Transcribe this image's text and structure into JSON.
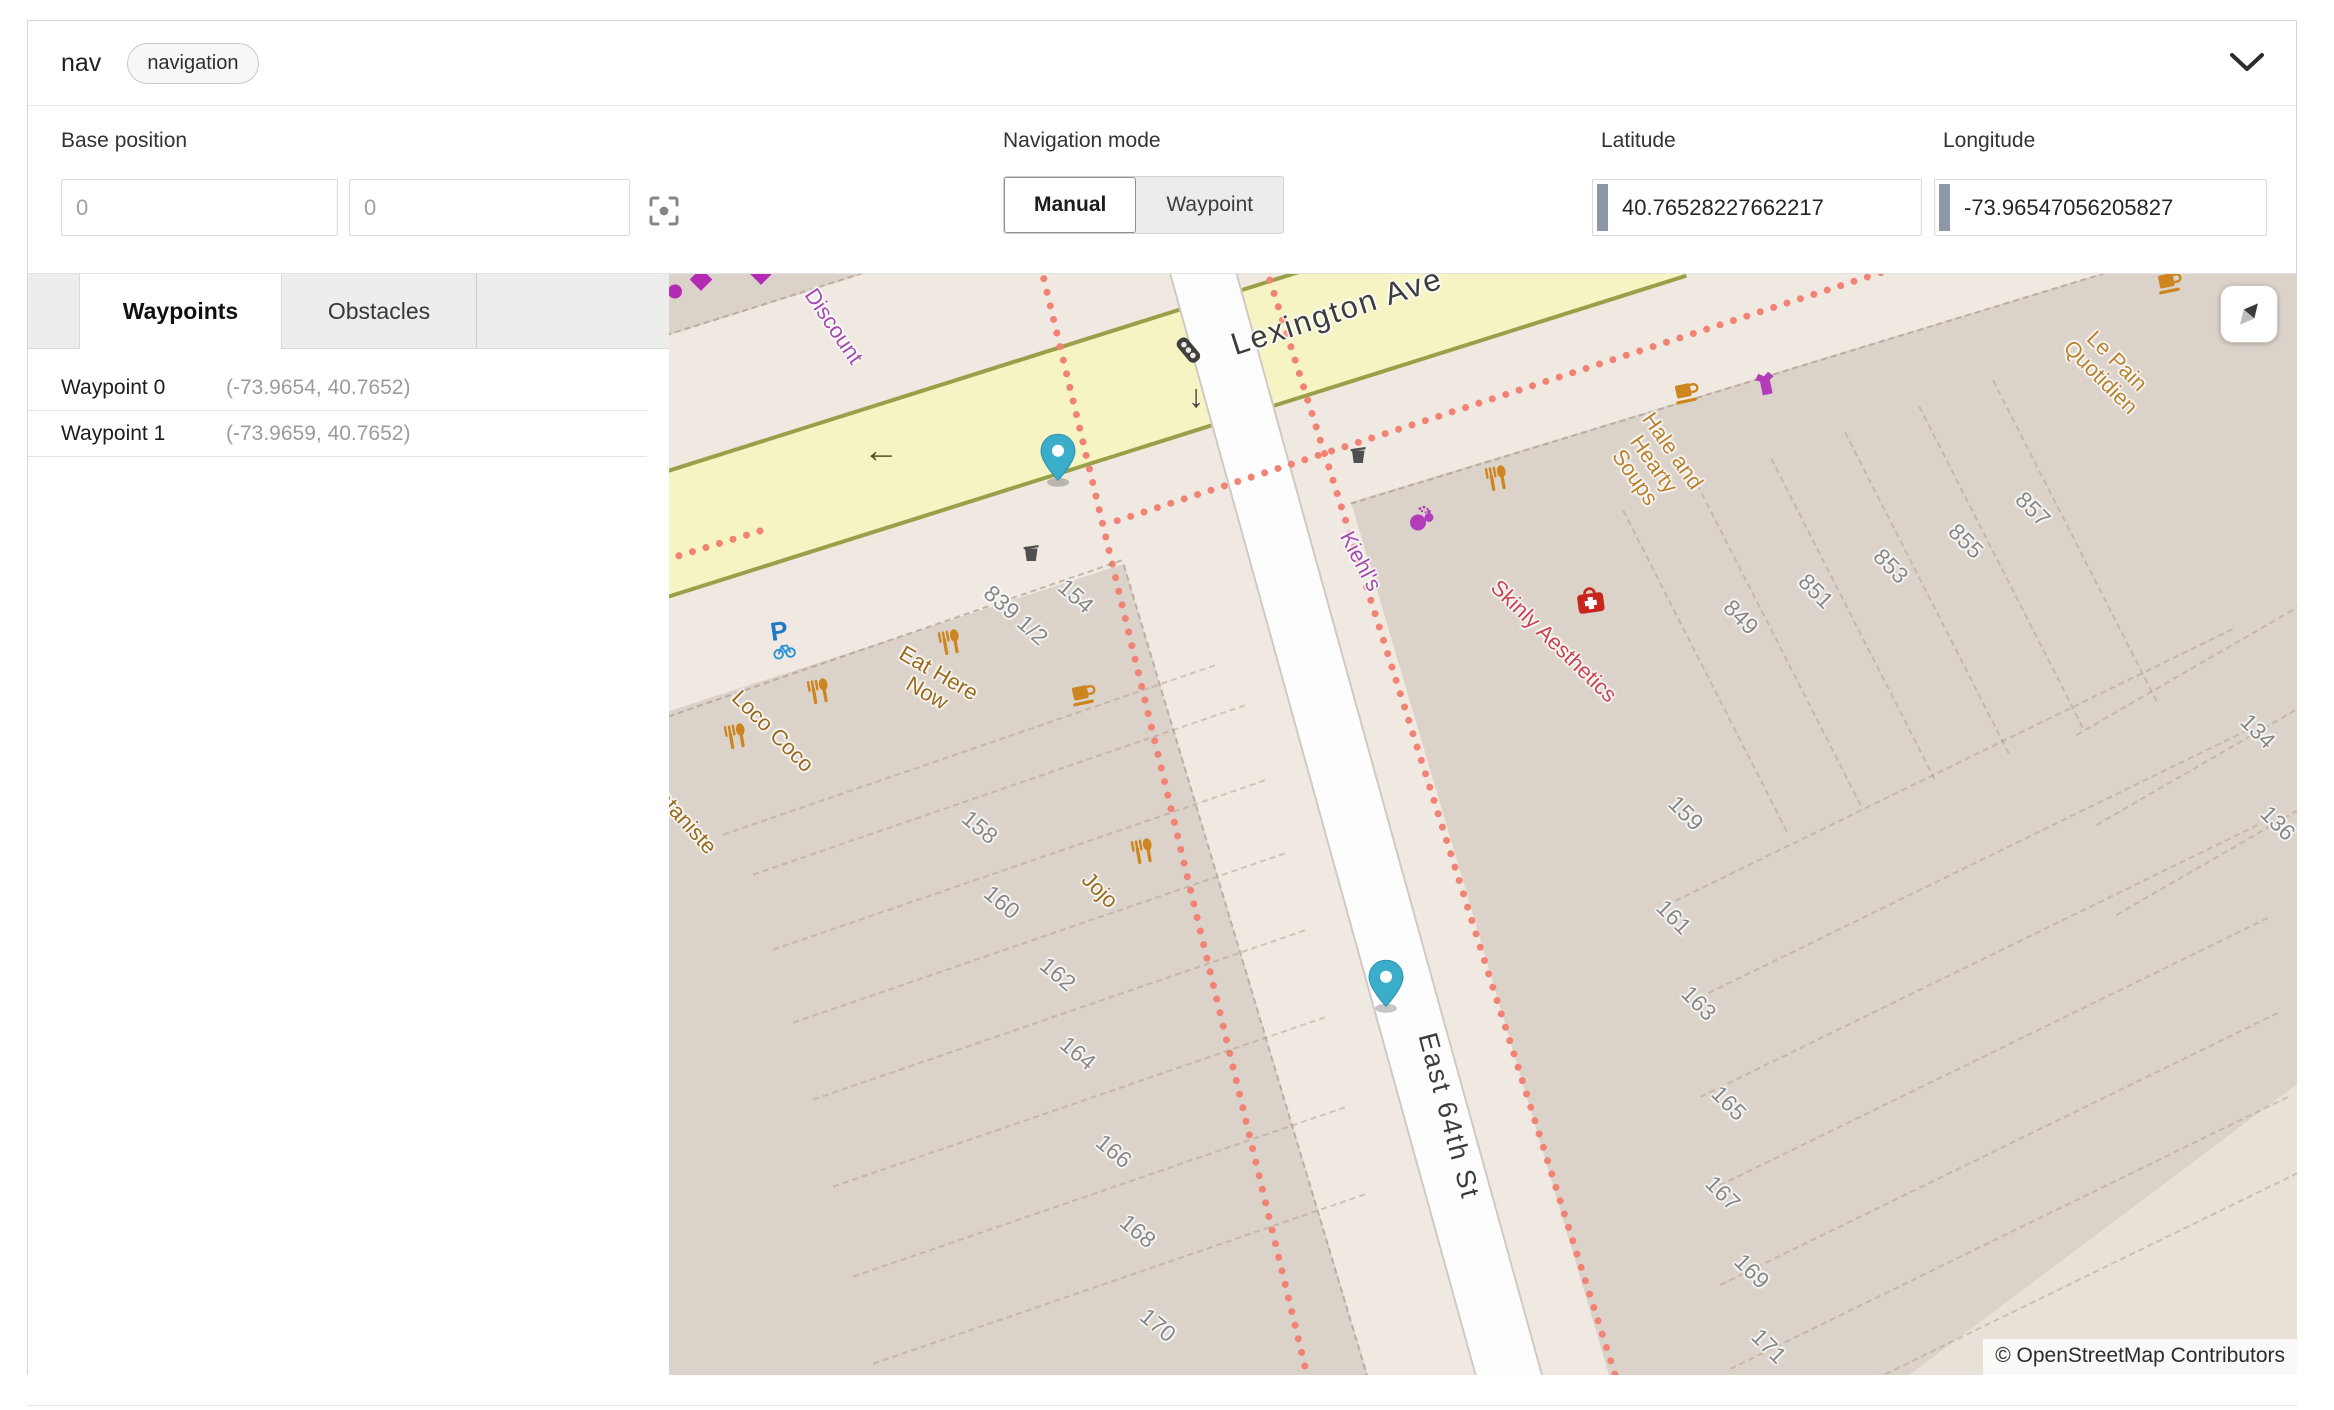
{
  "header": {
    "title": "nav",
    "badge": "navigation"
  },
  "toolbar": {
    "base_position": {
      "label": "Base position",
      "x_placeholder": "0",
      "y_placeholder": "0"
    },
    "navigation_mode": {
      "label": "Navigation mode",
      "options": [
        "Manual",
        "Waypoint"
      ],
      "selected": "Manual"
    },
    "latitude": {
      "label": "Latitude",
      "value": "40.76528227662217"
    },
    "longitude": {
      "label": "Longitude",
      "value": "-73.96547056205827"
    }
  },
  "tabs": {
    "items": [
      "Waypoints",
      "Obstacles"
    ],
    "active": "Waypoints"
  },
  "waypoints": [
    {
      "name": "Waypoint 0",
      "coords": "(-73.9654, 40.7652)"
    },
    {
      "name": "Waypoint 1",
      "coords": "(-73.9659, 40.7652)"
    }
  ],
  "map": {
    "attribution": "© OpenStreetMap Contributors",
    "palette": {
      "street_label": "#3c3c3c",
      "food_label": "#9a6a1c",
      "cafe_label": "#b9822f",
      "shop_label": "#a44bb0",
      "health_label": "#c9454f",
      "number_label": "#878787",
      "road_yellow": "#f6f4c3",
      "road_casing": "#9aa04a",
      "crossing_dash": "#f28374",
      "building": "#dbd2c9",
      "pin": "#3aadca"
    },
    "street_labels": [
      {
        "text": "Lexington Ave",
        "x": 668,
        "y": 38,
        "rot": -18,
        "size": 31,
        "kind": "street"
      },
      {
        "text": "East 64th St",
        "x": 780,
        "y": 842,
        "rot": 75,
        "size": 27,
        "kind": "street"
      }
    ],
    "poi_labels": [
      {
        "lines": [
          "Discount"
        ],
        "x": 165,
        "y": 52,
        "rot": 56,
        "kind": "shop"
      },
      {
        "lines": [
          "Kiehl's"
        ],
        "x": 692,
        "y": 287,
        "rot": 62,
        "kind": "shop"
      },
      {
        "lines": [
          "Hale and",
          "Hearty",
          "Soups"
        ],
        "x": 985,
        "y": 190,
        "rot": 55,
        "kind": "cafe"
      },
      {
        "lines": [
          "Le Pain",
          "Quotidien"
        ],
        "x": 1440,
        "y": 95,
        "rot": 45,
        "kind": "cafe"
      },
      {
        "lines": [
          "Skinly Aesthetics"
        ],
        "x": 885,
        "y": 367,
        "rot": 44,
        "kind": "health"
      },
      {
        "lines": [
          "Eat Here",
          "Now"
        ],
        "x": 264,
        "y": 409,
        "rot": 30,
        "kind": "food"
      },
      {
        "lines": [
          "Loco Coco"
        ],
        "x": 104,
        "y": 457,
        "rot": 45,
        "kind": "food"
      },
      {
        "lines": [
          "ataniste"
        ],
        "x": 18,
        "y": 548,
        "rot": 48,
        "kind": "food"
      },
      {
        "lines": [
          "Jojo"
        ],
        "x": 431,
        "y": 616,
        "rot": 45,
        "kind": "food"
      }
    ],
    "house_numbers": [
      {
        "text": "839 1/2",
        "x": 347,
        "y": 341,
        "rot": 42
      },
      {
        "text": "154",
        "x": 407,
        "y": 322,
        "rot": 42
      },
      {
        "text": "158",
        "x": 311,
        "y": 553,
        "rot": 40
      },
      {
        "text": "160",
        "x": 333,
        "y": 628,
        "rot": 40
      },
      {
        "text": "162",
        "x": 389,
        "y": 700,
        "rot": 40
      },
      {
        "text": "164",
        "x": 409,
        "y": 779,
        "rot": 40
      },
      {
        "text": "166",
        "x": 445,
        "y": 877,
        "rot": 40
      },
      {
        "text": "168",
        "x": 469,
        "y": 957,
        "rot": 40
      },
      {
        "text": "170",
        "x": 489,
        "y": 1051,
        "rot": 40
      },
      {
        "text": "849",
        "x": 1072,
        "y": 343,
        "rot": 45
      },
      {
        "text": "851",
        "x": 1147,
        "y": 317,
        "rot": 45
      },
      {
        "text": "853",
        "x": 1222,
        "y": 292,
        "rot": 45
      },
      {
        "text": "855",
        "x": 1297,
        "y": 267,
        "rot": 45
      },
      {
        "text": "857",
        "x": 1364,
        "y": 235,
        "rot": 45
      },
      {
        "text": "159",
        "x": 1017,
        "y": 539,
        "rot": 45
      },
      {
        "text": "161",
        "x": 1005,
        "y": 643,
        "rot": 45
      },
      {
        "text": "163",
        "x": 1030,
        "y": 729,
        "rot": 45
      },
      {
        "text": "165",
        "x": 1060,
        "y": 829,
        "rot": 45
      },
      {
        "text": "167",
        "x": 1054,
        "y": 919,
        "rot": 45
      },
      {
        "text": "169",
        "x": 1083,
        "y": 997,
        "rot": 45
      },
      {
        "text": "171",
        "x": 1100,
        "y": 1072,
        "rot": 45
      },
      {
        "text": "134",
        "x": 1589,
        "y": 457,
        "rot": 45
      },
      {
        "text": "136",
        "x": 1609,
        "y": 549,
        "rot": 45
      }
    ],
    "icons": [
      {
        "type": "diamond",
        "name": "shop-marker-icon",
        "x": 32,
        "y": 8
      },
      {
        "type": "diamond",
        "name": "shop-marker-icon",
        "x": 92,
        "y": 2
      },
      {
        "type": "dot",
        "name": "shop-marker-icon",
        "x": 6,
        "y": 20
      },
      {
        "type": "traffic",
        "name": "traffic-signals-icon",
        "x": 521,
        "y": 78,
        "rot": -40
      },
      {
        "type": "arrowdown",
        "name": "oneway-arrow-icon",
        "x": 527,
        "y": 122
      },
      {
        "type": "arrowleft",
        "name": "oneway-arrow-icon",
        "x": 212,
        "y": 176
      },
      {
        "type": "waste",
        "name": "waste-basket-icon",
        "x": 362,
        "y": 282
      },
      {
        "type": "waste",
        "name": "waste-basket-icon",
        "x": 689,
        "y": 184
      },
      {
        "type": "restaurant",
        "name": "restaurant-icon",
        "x": 280,
        "y": 371,
        "rot": -10
      },
      {
        "type": "restaurant",
        "name": "restaurant-icon",
        "x": 149,
        "y": 420,
        "rot": -10
      },
      {
        "type": "restaurant",
        "name": "restaurant-icon",
        "x": 66,
        "y": 465,
        "rot": -10
      },
      {
        "type": "restaurant",
        "name": "restaurant-icon",
        "x": 473,
        "y": 580,
        "rot": -10
      },
      {
        "type": "restaurant",
        "name": "restaurant-icon",
        "x": 827,
        "y": 207,
        "rot": -10
      },
      {
        "type": "cafe",
        "name": "cafe-icon",
        "x": 416,
        "y": 424,
        "rot": -12
      },
      {
        "type": "cafe",
        "name": "cafe-icon",
        "x": 1019,
        "y": 122,
        "rot": -12
      },
      {
        "type": "cafe",
        "name": "cafe-icon",
        "x": 1502,
        "y": 12,
        "rot": -12
      },
      {
        "type": "cosmetics",
        "name": "cosmetics-icon",
        "x": 755,
        "y": 247
      },
      {
        "type": "clothes",
        "name": "clothes-shop-icon",
        "x": 1097,
        "y": 112,
        "rot": -12
      },
      {
        "type": "firstaid",
        "name": "clinic-icon",
        "x": 922,
        "y": 330,
        "rot": -8
      },
      {
        "type": "bike",
        "name": "bicycle-parking-icon",
        "x": 114,
        "y": 368,
        "rot": -8
      }
    ],
    "pins": [
      {
        "name": "map-pin-0",
        "x": 389,
        "y": 214
      },
      {
        "name": "map-pin-1",
        "x": 717,
        "y": 740
      }
    ]
  }
}
